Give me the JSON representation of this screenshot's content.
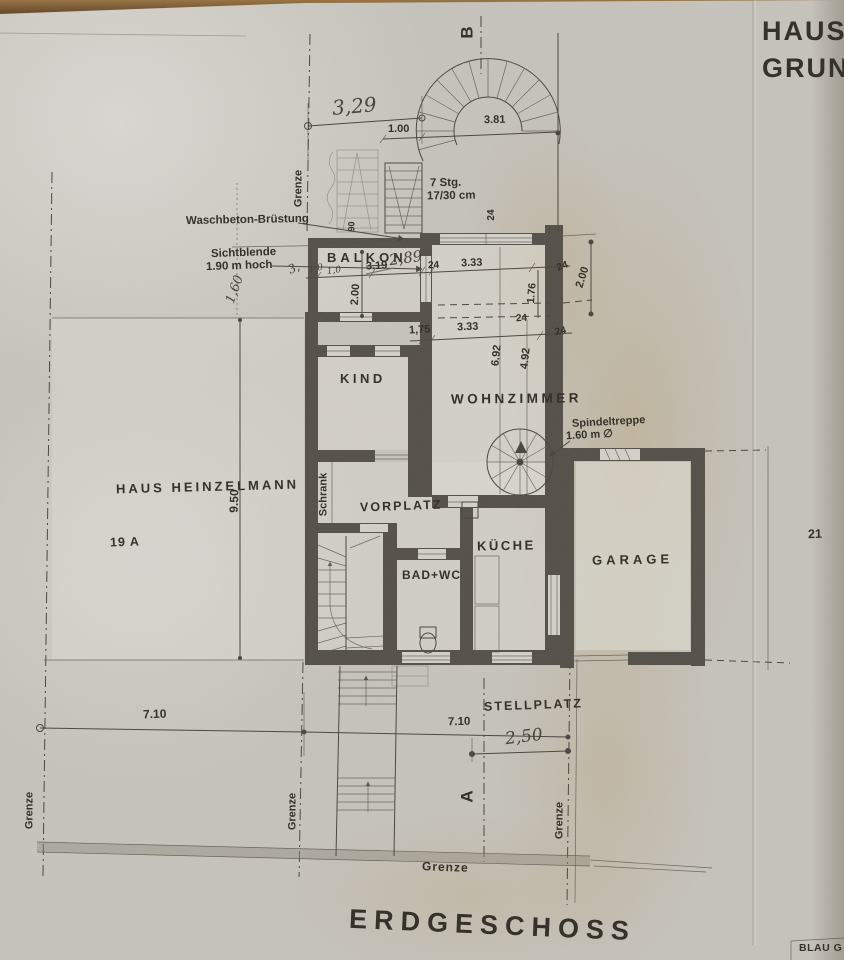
{
  "header": {
    "line1": "HAUS H",
    "line2": "GRUNDR"
  },
  "titles": {
    "floor": "ERDGESCHOSS",
    "stamp": "BLAU G"
  },
  "rooms": {
    "balkon": "BALKON",
    "kind": "KIND",
    "wohnzimmer": "WOHNZIMMER",
    "vorplatz": "VORPLATZ",
    "kueche": "KÜCHE",
    "bad_wc": "BAD+WC",
    "garage": "GARAGE",
    "stellplatz": "STELLPLATZ"
  },
  "parcel": {
    "owner": "HAUS HEINZELMANN",
    "house_number": "19 A",
    "neighbor_number": "21"
  },
  "annotations": {
    "waschbeton": "Waschbeton-Brüstung",
    "sichtblende_1": "Sichtblende",
    "sichtblende_2": "1.90 m hoch",
    "stairs_1": "7 Stg.",
    "stairs_2": "17/30 cm",
    "spindeltreppe_1": "Spindeltreppe",
    "spindeltreppe_2": "1.60 m ∅",
    "schrank": "Schrank",
    "grenze": "Grenze"
  },
  "sections": {
    "a": "A",
    "b": "B"
  },
  "dims": {
    "d_329": "3,29",
    "d_100": "1.00",
    "d_381": "3.81",
    "d_200": "2.00",
    "d_24": "24",
    "d_333": "3.33",
    "d_176": "1.76",
    "d_175": "1,75",
    "d_692": "6.92",
    "d_492": "4.92",
    "d_950": "9.50",
    "d_710": "7.10",
    "d_250": "2,50",
    "d_319_crossed": "3.19",
    "d_289": "2,89",
    "d_90": "90",
    "d_160": "1,60",
    "d_10": "1,0",
    "d_3": "3,"
  }
}
